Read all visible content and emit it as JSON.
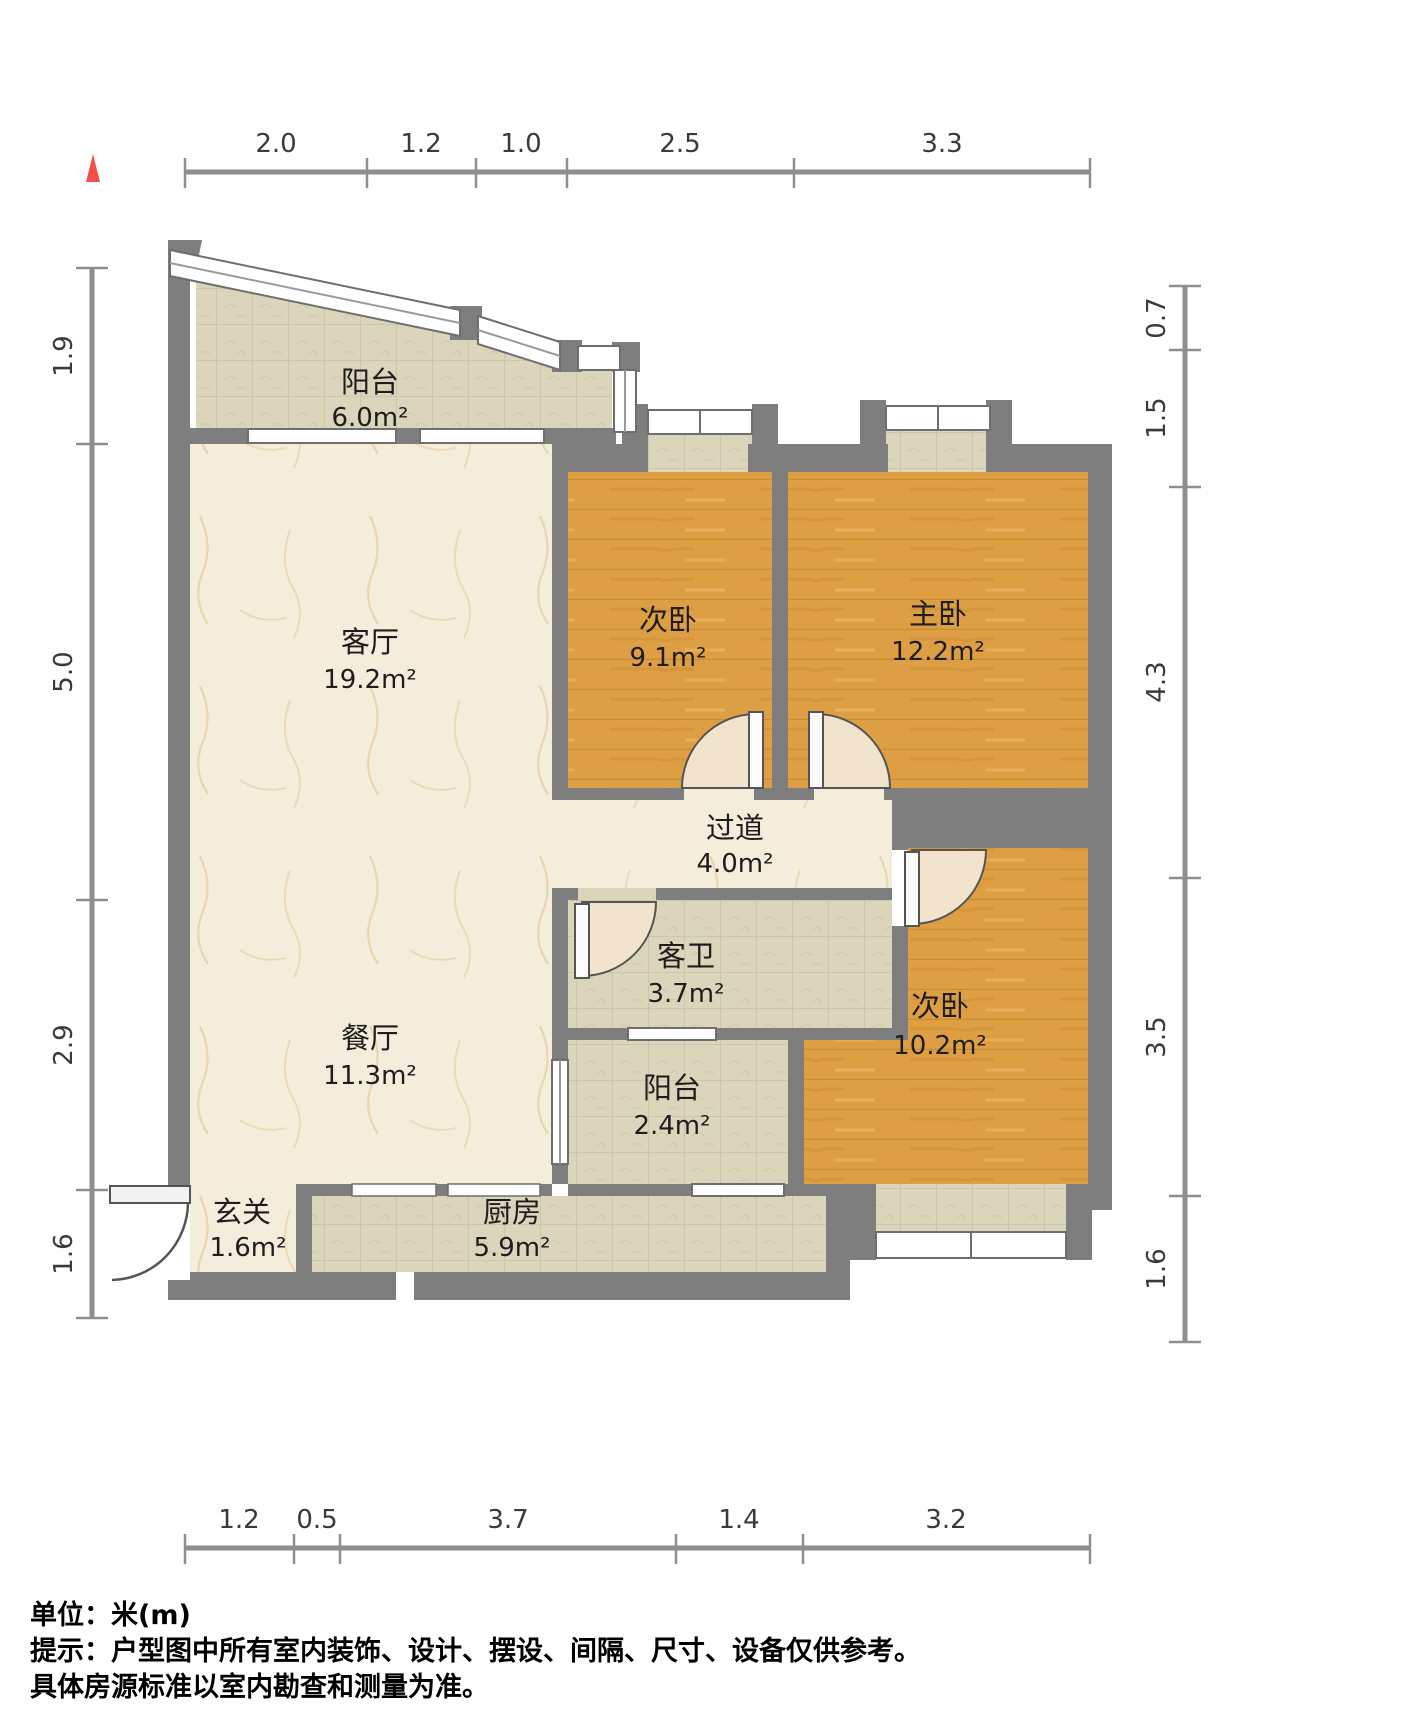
{
  "north_indicator": {
    "label": "north-arrow",
    "color": "#EF5047"
  },
  "rooms": [
    {
      "name": "阳台",
      "area": "6.0m²"
    },
    {
      "name": "客厅",
      "area": "19.2m²"
    },
    {
      "name": "次卧",
      "area": "9.1m²"
    },
    {
      "name": "主卧",
      "area": "12.2m²"
    },
    {
      "name": "过道",
      "area": "4.0m²"
    },
    {
      "name": "客卫",
      "area": "3.7m²"
    },
    {
      "name": "餐厅",
      "area": "11.3m²"
    },
    {
      "name": "次卧",
      "area": "10.2m²"
    },
    {
      "name": "阳台",
      "area": "2.4m²"
    },
    {
      "name": "玄关",
      "area": "1.6m²"
    },
    {
      "name": "厨房",
      "area": "5.9m²"
    }
  ],
  "dimensions": {
    "top": [
      "2.0",
      "1.2",
      "1.0",
      "2.5",
      "3.3"
    ],
    "bottom": [
      "1.2",
      "0.5",
      "3.7",
      "1.4",
      "3.2"
    ],
    "left": [
      "1.9",
      "5.0",
      "2.9",
      "1.6"
    ],
    "right": [
      "0.7",
      "1.5",
      "4.3",
      "3.5",
      "1.6"
    ]
  },
  "footer": {
    "line1": "单位：米(m)",
    "line2": "提示：户型图中所有室内装饰、设计、摆设、间隔、尺寸、设备仅供参考。",
    "line3": "具体房源标准以室内勘查和测量为准。"
  },
  "colors": {
    "wall": "#7E7E7E",
    "wood_floor": "#DE9E44",
    "tile_floor": "#DBD5BC",
    "marble_floor": "#F5EDDC",
    "door_fan": "#F2E4CC",
    "dim_line": "#8F8F8F",
    "north": "#EF5047"
  }
}
